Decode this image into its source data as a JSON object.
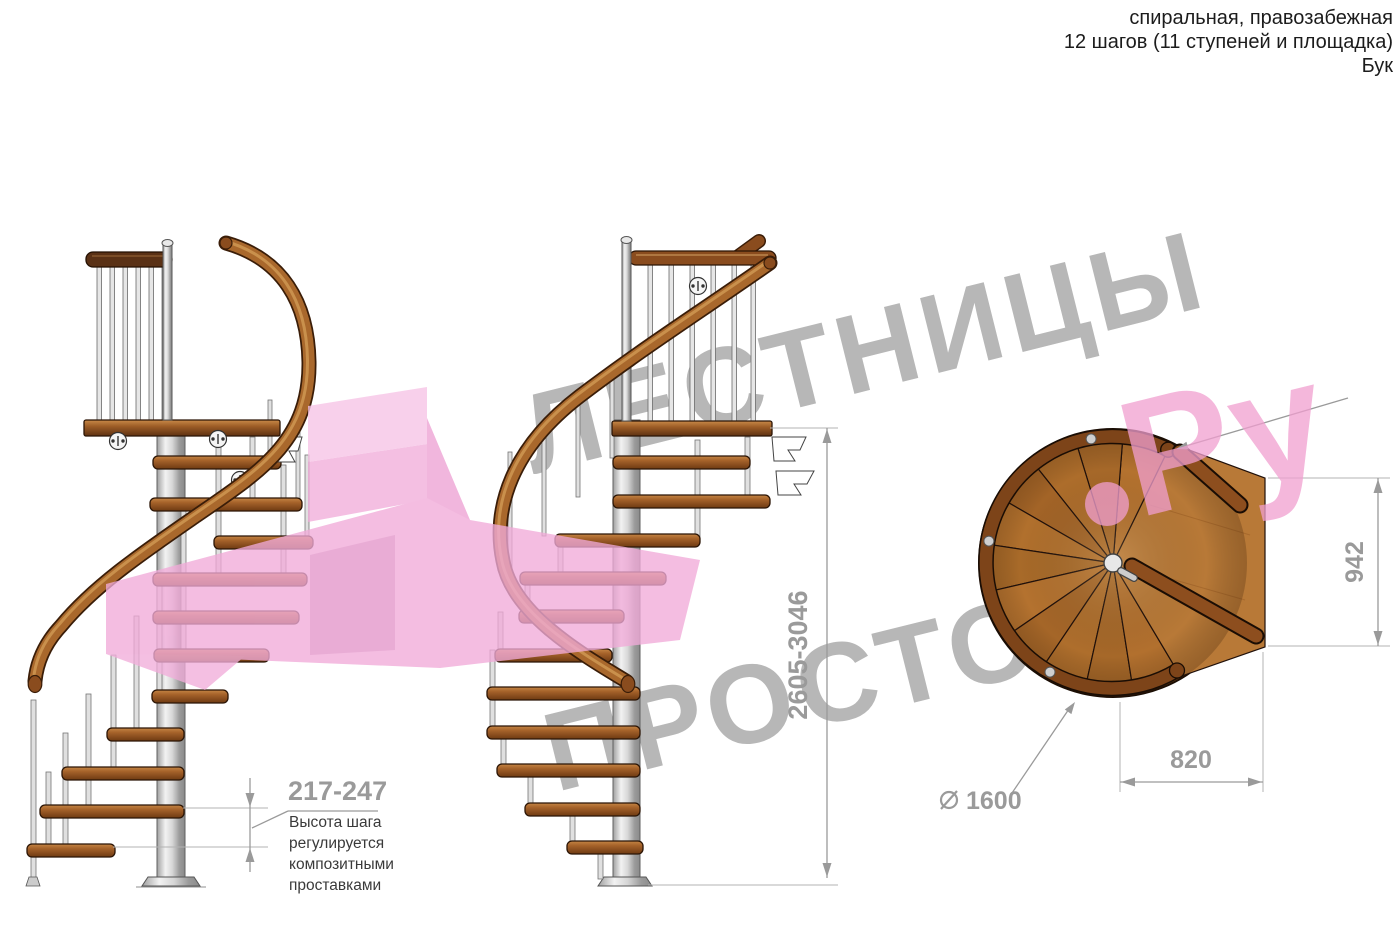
{
  "header": {
    "line1": "спиральная, правозабежная",
    "line2": "12 шагов (11 ступеней и площадка)",
    "line3": "Бук"
  },
  "watermark": {
    "word1": "ЛЕСТНИЦЫ",
    "word2": "ПРОСТО",
    "suffix": "Ру",
    "gray": "#b7b7b7",
    "pink": "#f19fd0"
  },
  "dimensions": {
    "step_height": {
      "value": "217-247",
      "note": [
        "Высота шага",
        "регулируется",
        "композитными",
        "проставками"
      ]
    },
    "total_height": {
      "value": "2605-3046"
    },
    "landing_length": {
      "value": "942"
    },
    "landing_width": {
      "value": "820"
    },
    "diameter": {
      "symbol": "⌀",
      "value": "1600"
    }
  },
  "colors": {
    "wood": "#a5622a",
    "wood_dark": "#6e3a12",
    "rail_brown": "#a9682c",
    "metal": "#d6d6d6",
    "dimension_gray": "#9a9a9a",
    "watermark_gray": "#b7b7b7",
    "watermark_pink": "#f19fd0",
    "arrow_pink": "#f2aedb"
  }
}
